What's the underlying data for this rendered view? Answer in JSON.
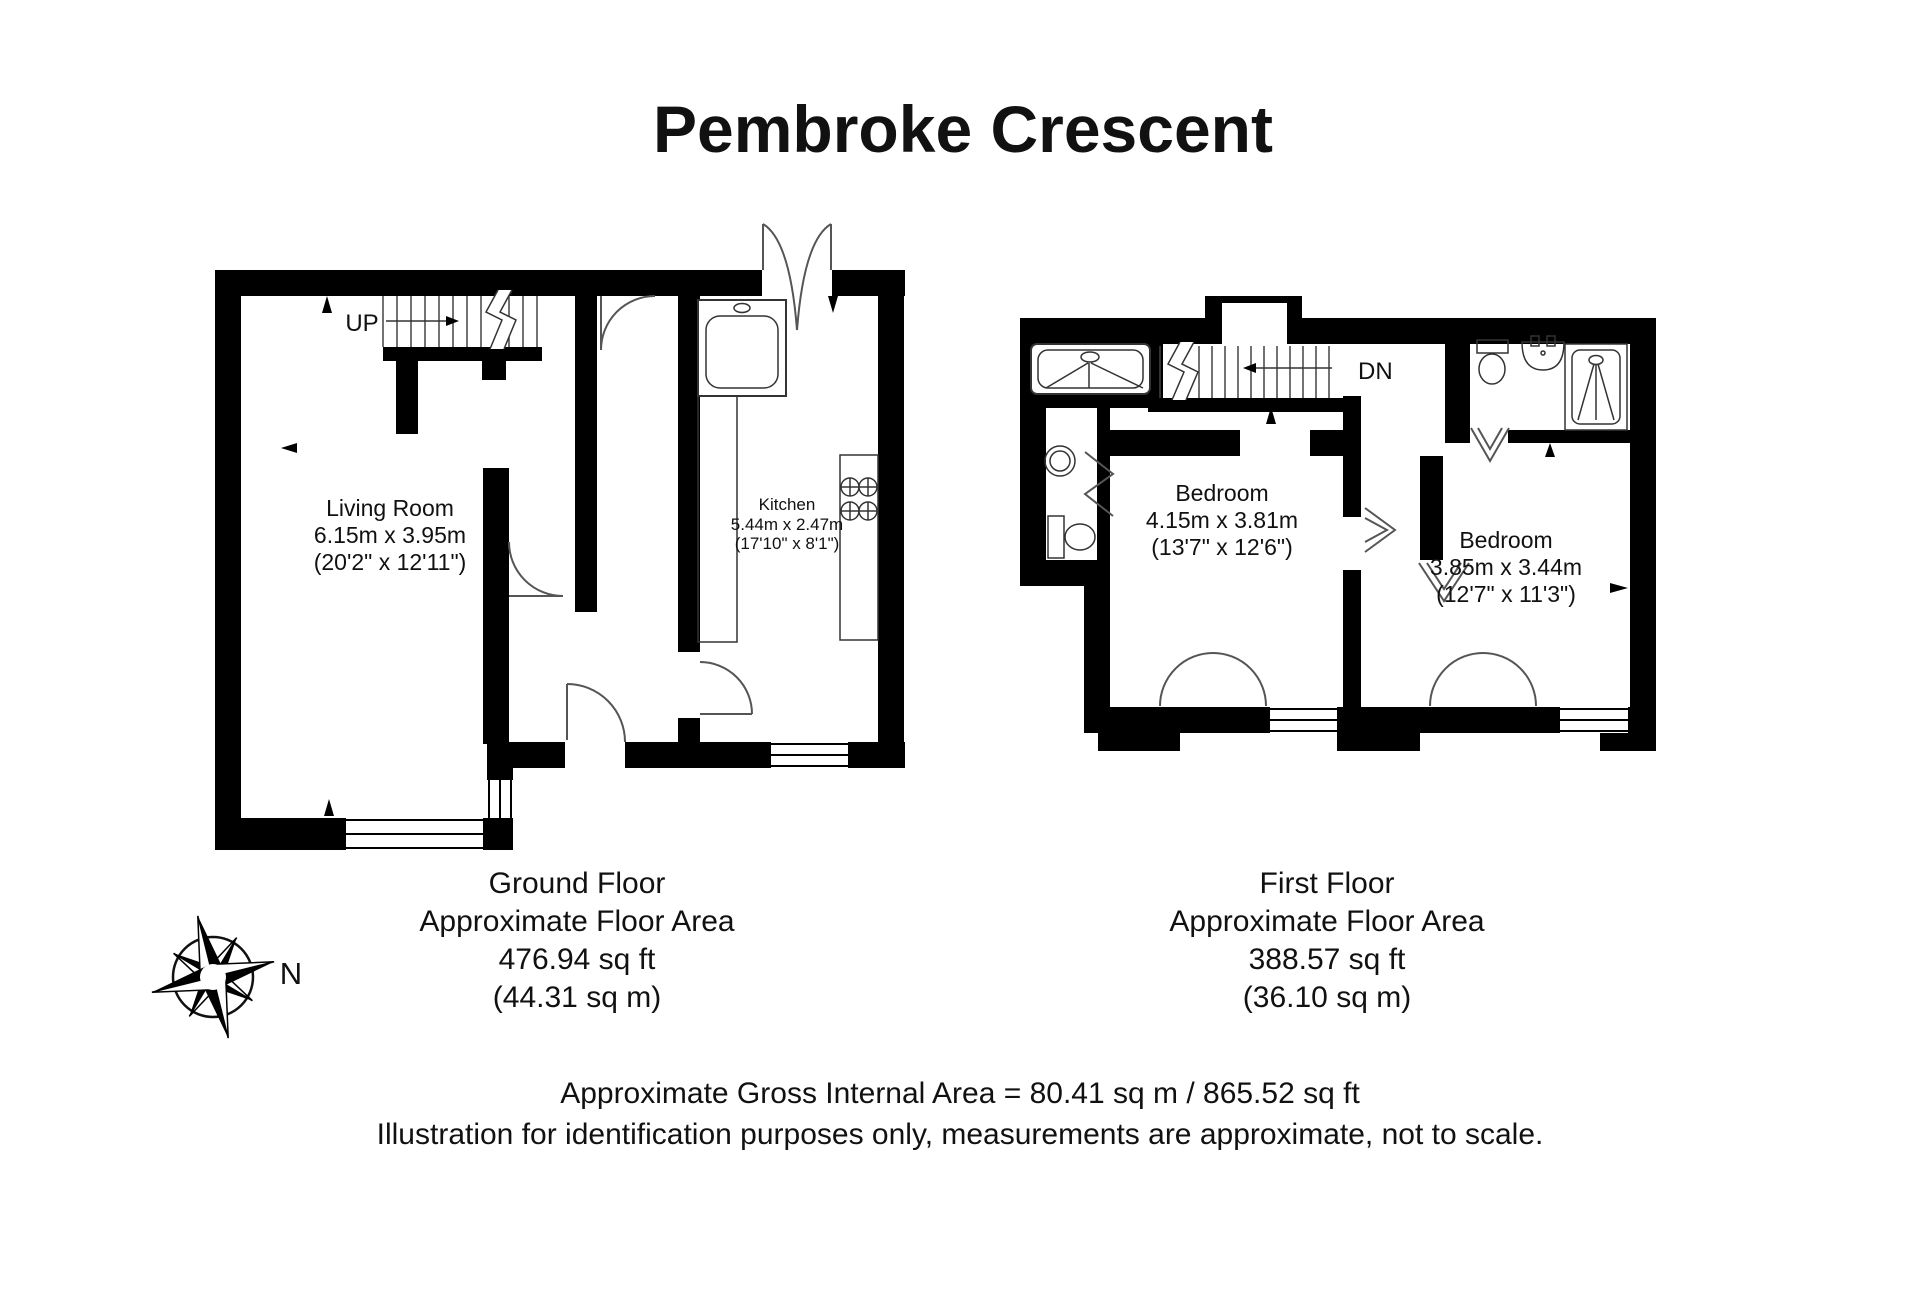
{
  "title": "Pembroke Crescent",
  "ground_floor": {
    "stairs_label": "UP",
    "living_room": {
      "name": "Living Room",
      "metric": "6.15m x 3.95m",
      "imperial": "(20'2\" x 12'11\")"
    },
    "kitchen": {
      "name": "Kitchen",
      "metric": "5.44m x 2.47m",
      "imperial": "(17'10\" x 8'1\")"
    },
    "summary": {
      "name": "Ground Floor",
      "subtitle": "Approximate Floor Area",
      "area_ft": "476.94 sq ft",
      "area_m": "(44.31 sq m)"
    }
  },
  "first_floor": {
    "stairs_label": "DN",
    "bedroom1": {
      "name": "Bedroom",
      "metric": "4.15m x 3.81m",
      "imperial": "(13'7\" x 12'6\")"
    },
    "bedroom2": {
      "name": "Bedroom",
      "metric": "3.85m x 3.44m",
      "imperial": "(12'7\" x 11'3\")"
    },
    "summary": {
      "name": "First Floor",
      "subtitle": "Approximate Floor Area",
      "area_ft": "388.57 sq ft",
      "area_m": "(36.10 sq m)"
    }
  },
  "compass": {
    "north_label": "N"
  },
  "footer": {
    "line1": "Approximate Gross Internal Area = 80.41 sq m / 865.52 sq ft",
    "line2": "Illustration for identification purposes only, measurements are approximate, not to scale."
  },
  "colors": {
    "wall": "#000000",
    "line": "#333333",
    "text": "#111111",
    "background": "#ffffff"
  }
}
